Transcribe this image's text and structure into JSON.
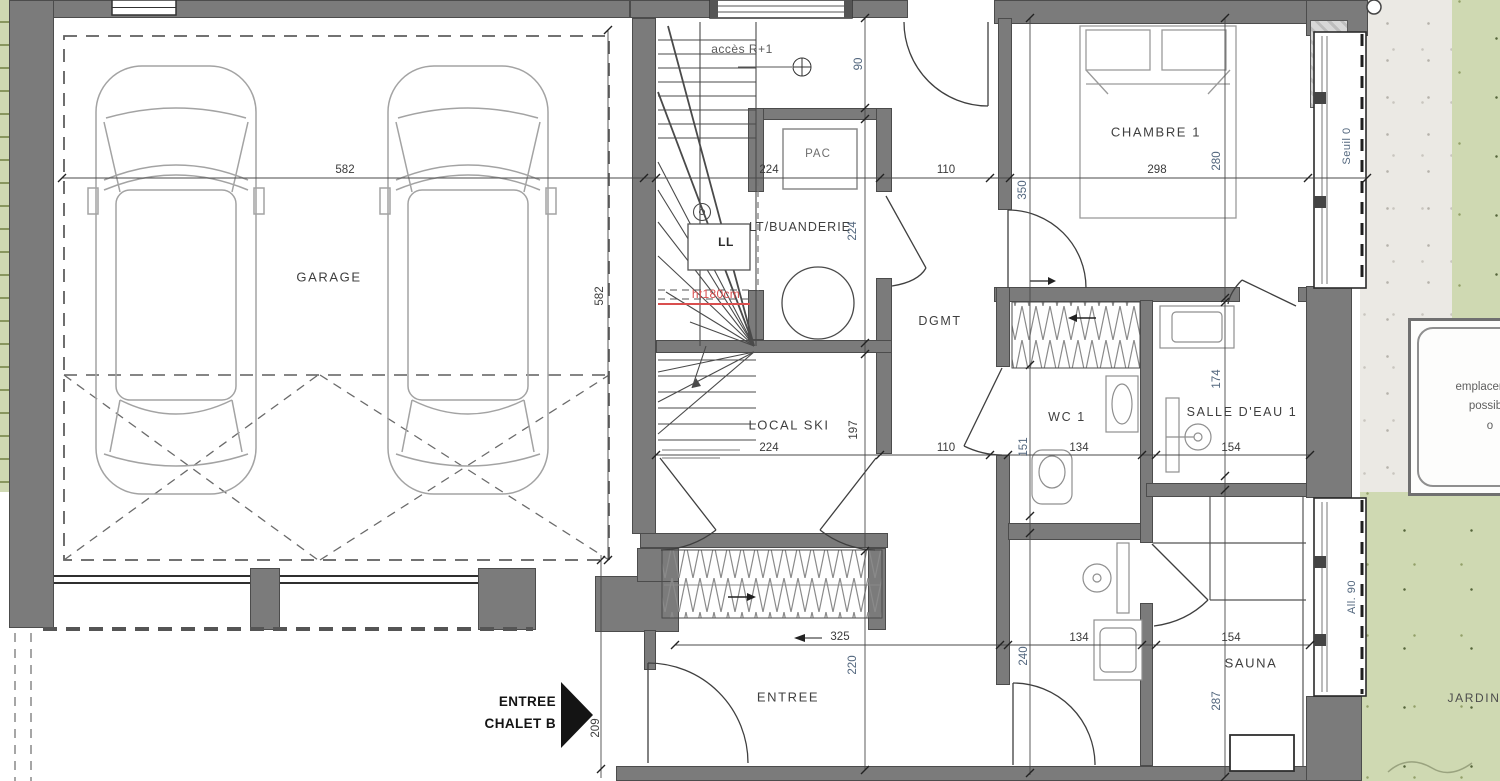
{
  "colors": {
    "wall": "#7b7b7b",
    "garden_green": "#cfd9b2",
    "gravel": "#ebe9e4",
    "annotation_red": "#d94f4f",
    "dim_blue": "#53677e",
    "line": "#3a3a3a"
  },
  "rooms": {
    "garage": "GARAGE",
    "pac": "PAC",
    "buanderie": "LT/BUANDERIE",
    "washer": "LL",
    "dgmt": "DGMT",
    "chambre1": "CHAMBRE 1",
    "wc1": "WC 1",
    "salle_eau1": "SALLE D'EAU 1",
    "local_ski": "LOCAL SKI",
    "entree": "ENTREE",
    "sauna": "SAUNA",
    "jardin": "JARDIN"
  },
  "annotations": {
    "acces": "accès R+1",
    "height_note": "ht180cm",
    "entrance_line1": "ENTREE",
    "entrance_line2": "CHALET B",
    "seuil": "Seuil 0",
    "allege": "All. 90",
    "emplacement_line1": "emplacement",
    "emplacement_line2": "possible",
    "emplacement_line3": "o"
  },
  "dims": {
    "garage_w": "582",
    "garage_d": "582",
    "stair_w": "224",
    "hall_top": "110",
    "chambre_w": "298",
    "pac_top": "90",
    "buanderie_d": "224",
    "chambre_left_d": "350",
    "chambre_d": "280",
    "ski_w": "224",
    "ski_d": "197",
    "hall_mid": "110",
    "wc_niche": "151",
    "wc_w": "134",
    "sde_w": "154",
    "sde_d": "174",
    "entree_w": "325",
    "entree_d": "220",
    "porch_d": "209",
    "shower_d": "240",
    "shower_w": "134",
    "sauna_w": "154",
    "sauna_d": "287"
  }
}
